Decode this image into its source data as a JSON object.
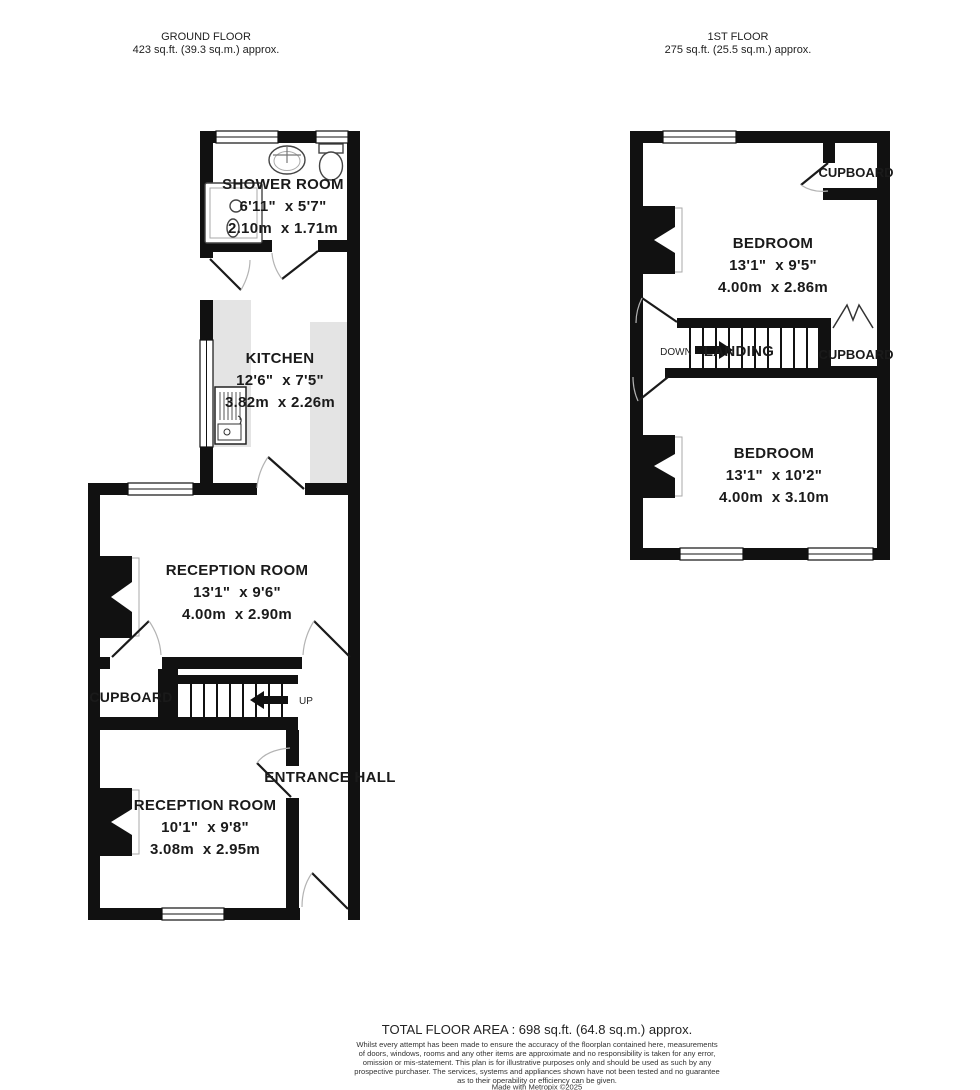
{
  "header": {
    "ground": {
      "title": "GROUND FLOOR",
      "area": "423 sq.ft. (39.3 sq.m.) approx."
    },
    "first": {
      "title": "1ST FLOOR",
      "area": "275 sq.ft. (25.5 sq.m.) approx."
    }
  },
  "ground": {
    "shower": {
      "name": "SHOWER ROOM",
      "imperial": "6'11\"  x 5'7\"",
      "metric": "2.10m  x 1.71m"
    },
    "kitchen": {
      "name": "KITCHEN",
      "imperial": "12'6\"  x 7'5\"",
      "metric": "3.82m  x 2.26m"
    },
    "reception1": {
      "name": "RECEPTION ROOM",
      "imperial": "13'1\"  x 9'6\"",
      "metric": "4.00m  x 2.90m"
    },
    "reception2": {
      "name": "RECEPTION ROOM",
      "imperial": "10'1\"  x 9'8\"",
      "metric": "3.08m  x 2.95m"
    },
    "cupboard_label": "CUPBOARD",
    "up_label": "UP",
    "entrance_label": "ENTRANCE HALL"
  },
  "first": {
    "bedroom1": {
      "name": "BEDROOM",
      "imperial": "13'1\"  x 9'5\"",
      "metric": "4.00m  x 2.86m"
    },
    "bedroom2": {
      "name": "BEDROOM",
      "imperial": "13'1\"  x 10'2\"",
      "metric": "4.00m  x 3.10m"
    },
    "cupboard_top_label": "CUPBOARD",
    "cupboard_mid_label": "CUPBOARD",
    "landing_label": "LANDING",
    "down_label": "DOWN"
  },
  "fixtures": {
    "ground": [
      "shower-enclosure",
      "basin",
      "toilet",
      "sink-unit",
      "staircase-up",
      "worktops"
    ],
    "first": [
      "staircase-down",
      "bifold-cupboard-door"
    ]
  },
  "colors": {
    "wall": "#111111",
    "counter": "#e4e4e4"
  },
  "footer": {
    "total": "TOTAL FLOOR AREA : 698 sq.ft. (64.8 sq.m.) approx.",
    "disclaimer": [
      "Whilst every attempt has been made to ensure the accuracy of the floorplan contained here, measurements",
      "of doors, windows, rooms and any other items are approximate and no responsibility is taken for any error,",
      "omission or mis-statement. This plan is for illustrative purposes only and should be used as such by any",
      "prospective purchaser. The services, systems and appliances shown have not been tested and no guarantee",
      "as to their operability or efficiency can be given."
    ],
    "credit": "Made with Metropix ©2025"
  }
}
